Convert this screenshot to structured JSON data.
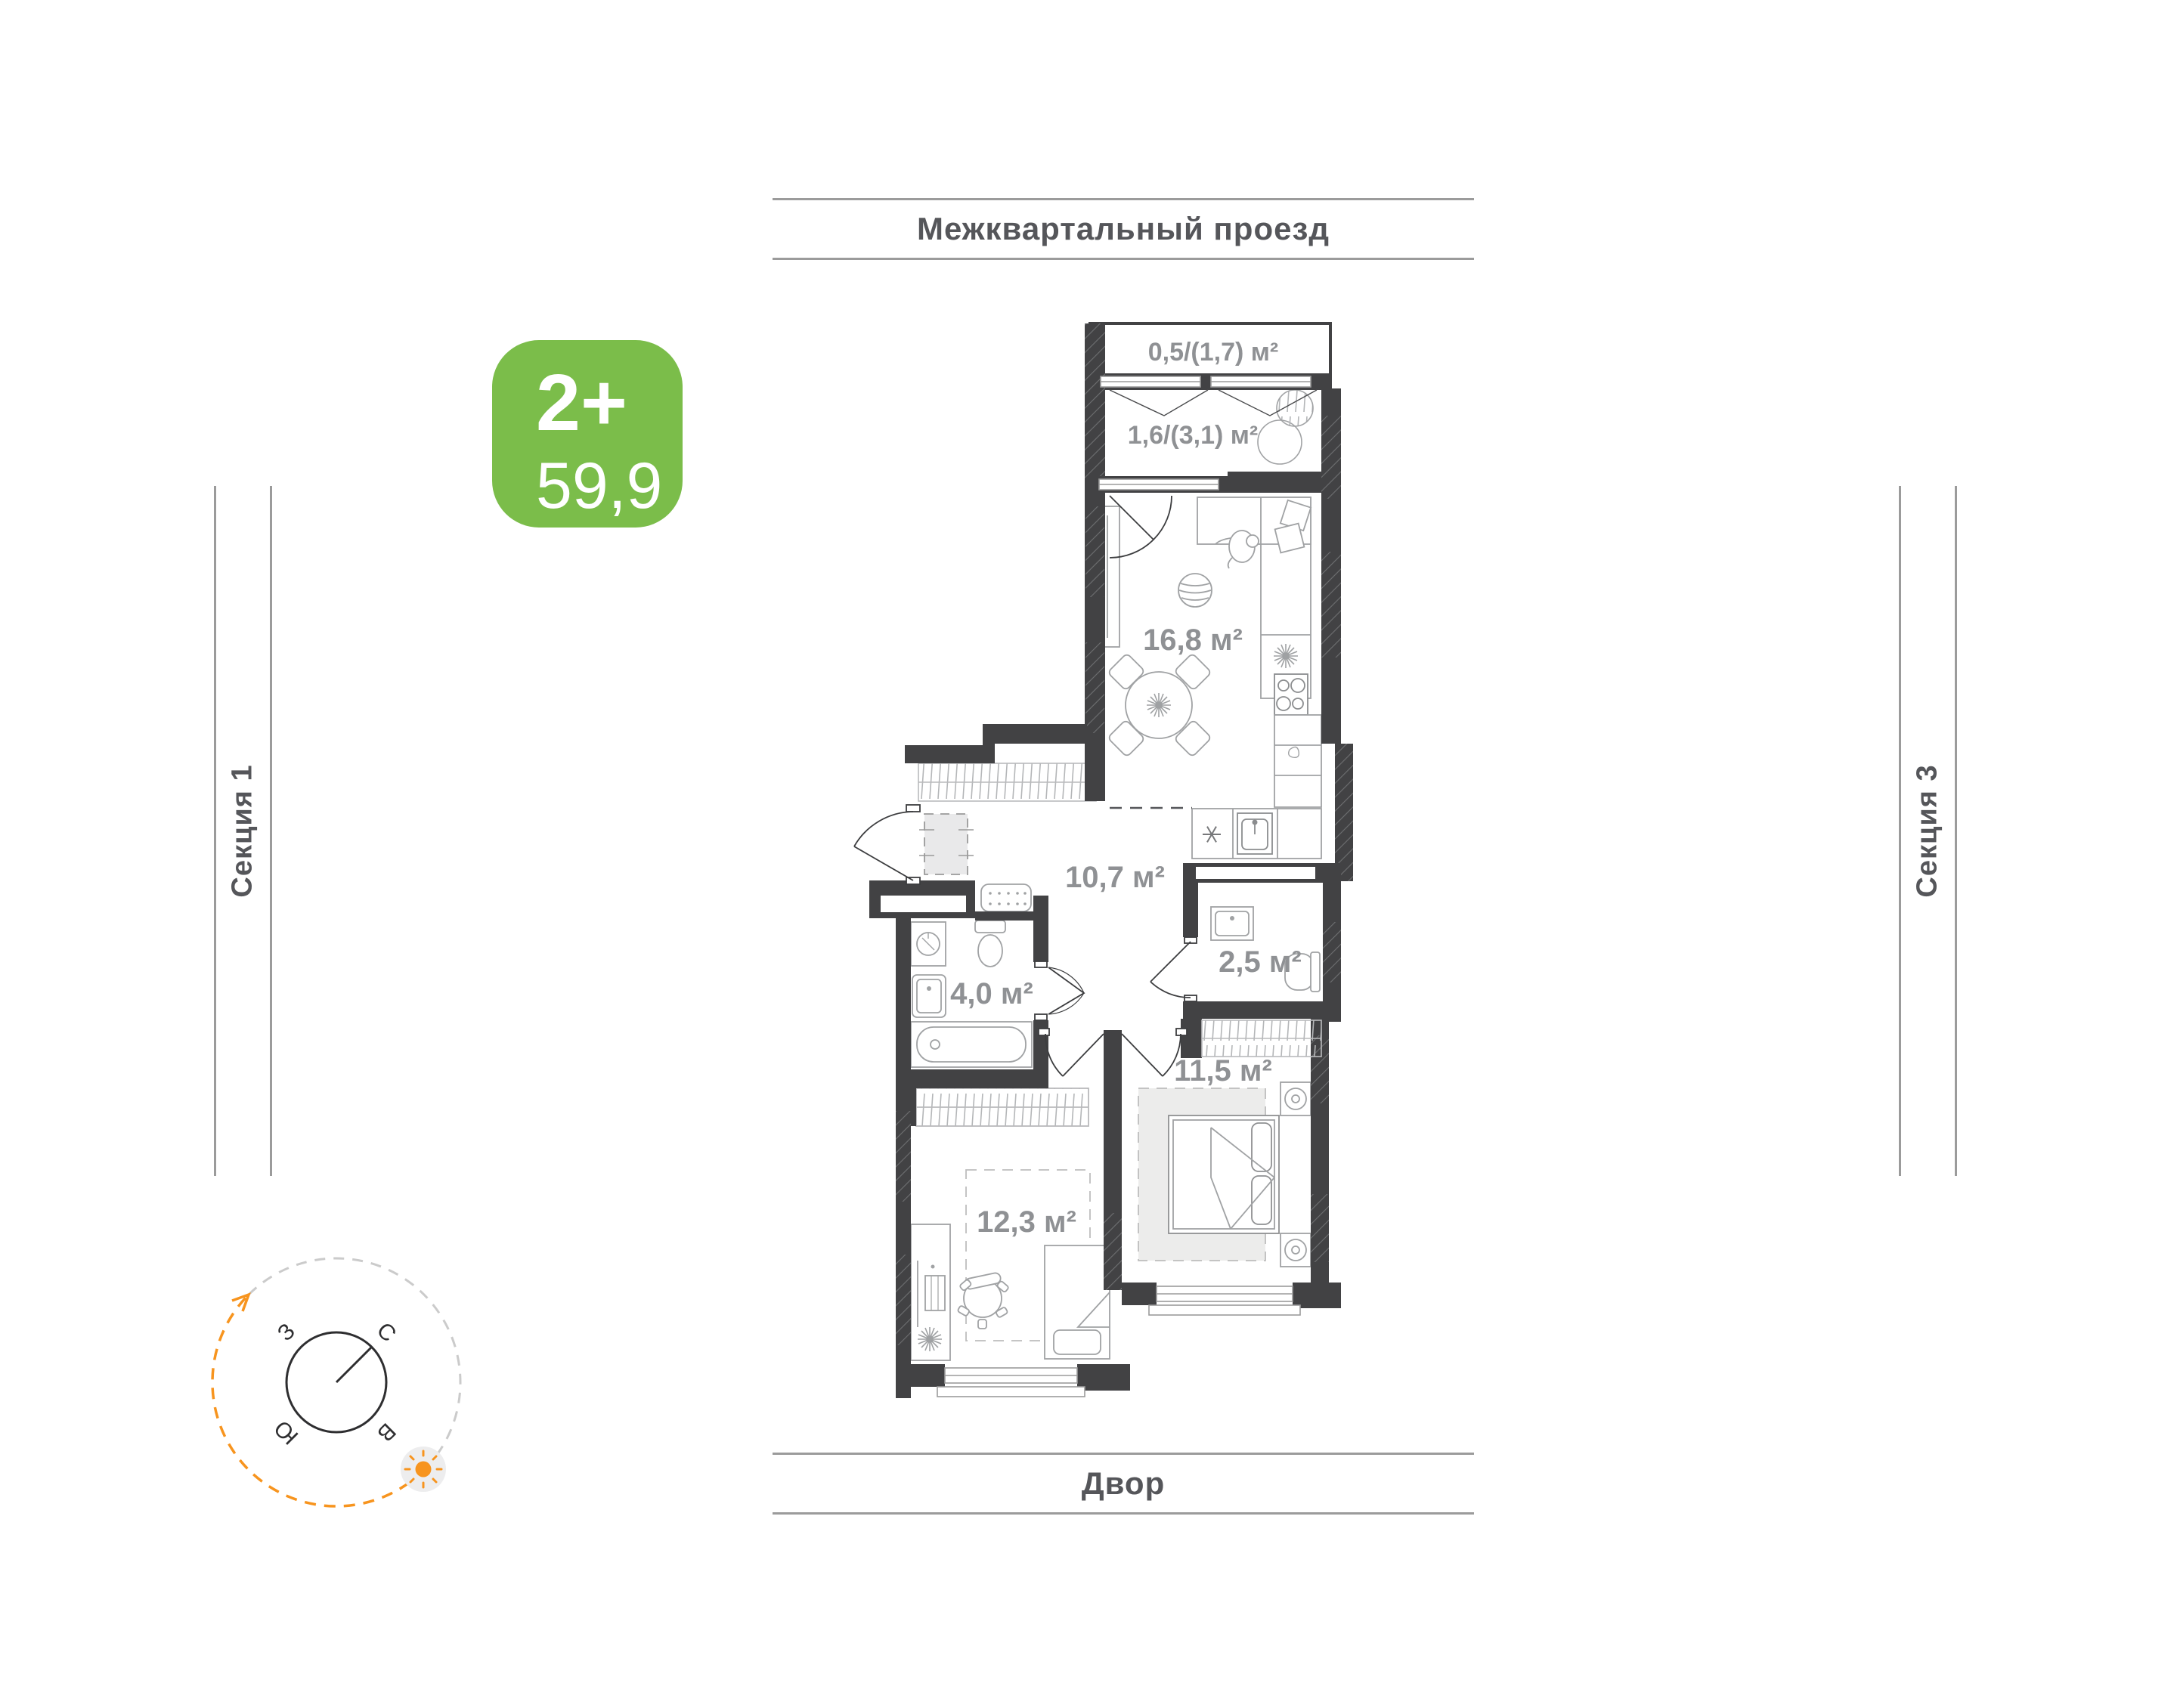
{
  "surroundings": {
    "top": "Межквартальный проезд",
    "bottom": "Двор",
    "left": "Секция 1",
    "right": "Секция 3"
  },
  "badge": {
    "rooms": "2+",
    "area": "59,9"
  },
  "rooms": {
    "balcony": {
      "label": "0,5/(1,7) м²"
    },
    "loggia": {
      "label": "1,6/(3,1) м²"
    },
    "kitchen_living": {
      "label": "16,8 м²"
    },
    "hallway": {
      "label": "10,7 м²"
    },
    "wc": {
      "label": "2,5 м²"
    },
    "bathroom": {
      "label": "4,0 м²"
    },
    "bedroom": {
      "label": "11,5 м²"
    },
    "room": {
      "label": "12,3 м²"
    }
  },
  "compass": {
    "north": "С",
    "west": "З",
    "south": "Ю",
    "east": "В"
  },
  "colors": {
    "accent_green": "#7bbd4a",
    "accent_orange": "#f7941e",
    "wall": "#424244",
    "area_label_gray": "#8f9194",
    "street_text_gray": "#55565a",
    "line_gray": "#9b9b9b"
  }
}
